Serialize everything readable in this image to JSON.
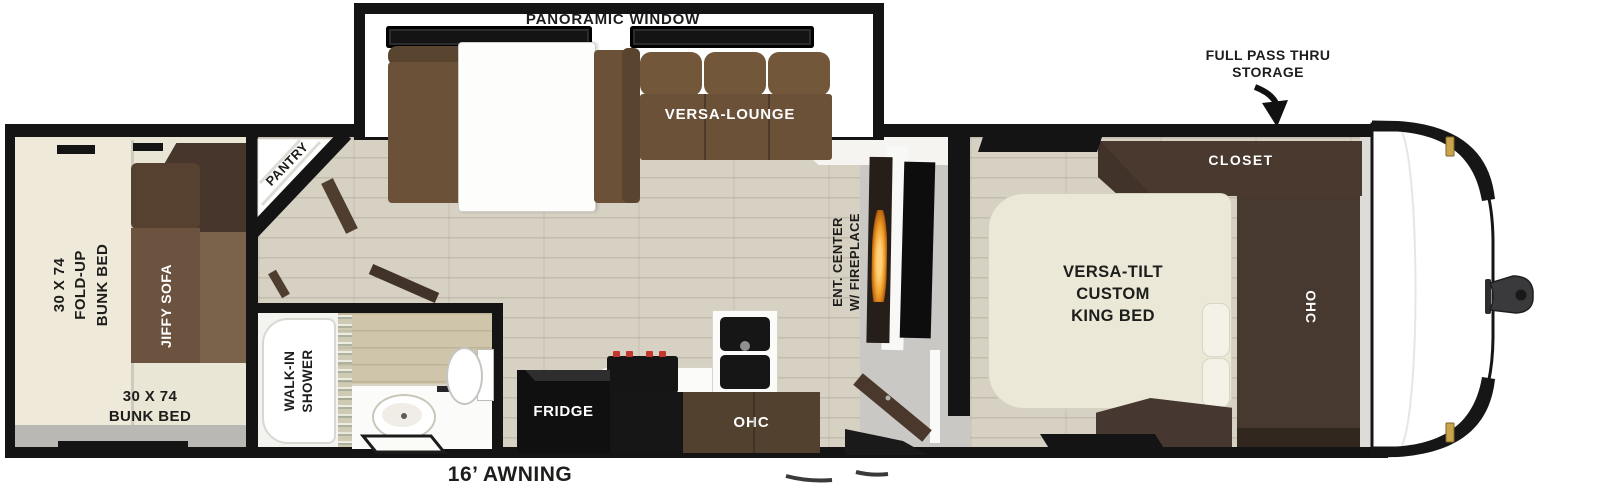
{
  "title": "Travel trailer floorplan",
  "slideout": {
    "panoramic_window": "PANORAMIC WINDOW",
    "versa_lounge": "VERSA-LOUNGE"
  },
  "bunk_room": {
    "fold_up_bunk": {
      "lines": [
        "30 X 74",
        "FOLD-UP",
        "BUNK BED"
      ]
    },
    "jiffy_sofa": "JIFFY SOFA",
    "bunk_bed": {
      "lines": [
        "30 X 74",
        "BUNK BED"
      ]
    }
  },
  "pantry": "PANTRY",
  "bathroom": {
    "walk_in_shower": {
      "lines": [
        "WALK-IN",
        "SHOWER"
      ]
    }
  },
  "kitchen": {
    "fridge": "FRIDGE",
    "ohc": "OHC"
  },
  "living_room": {
    "ent_center": {
      "lines": [
        "ENT. CENTER",
        "W/ FIREPLACE"
      ]
    }
  },
  "bedroom": {
    "closet": "CLOSET",
    "king_bed": {
      "lines": [
        "VERSA-TILT",
        "CUSTOM",
        "KING BED"
      ]
    },
    "ohc": "OHC"
  },
  "callouts": {
    "pass_thru_storage": {
      "lines": [
        "FULL PASS THRU",
        "STORAGE"
      ]
    },
    "awning": "16’ AWNING"
  },
  "colors": {
    "outline": "#141414",
    "wood_floor": "#d6d1c2",
    "bunk_cream": "#eae6d6",
    "sofa_brown": "#6b5138",
    "cabinet_brown": "#48372d",
    "counter_white": "#fbfbf9",
    "flame_orange": "#f0a02a",
    "shower_glass": "#ccdcd2",
    "marker_gold": "#c9a44a",
    "walkway_gray": "#c9c8c4",
    "bath_floor_tan": "#cec5ab"
  }
}
